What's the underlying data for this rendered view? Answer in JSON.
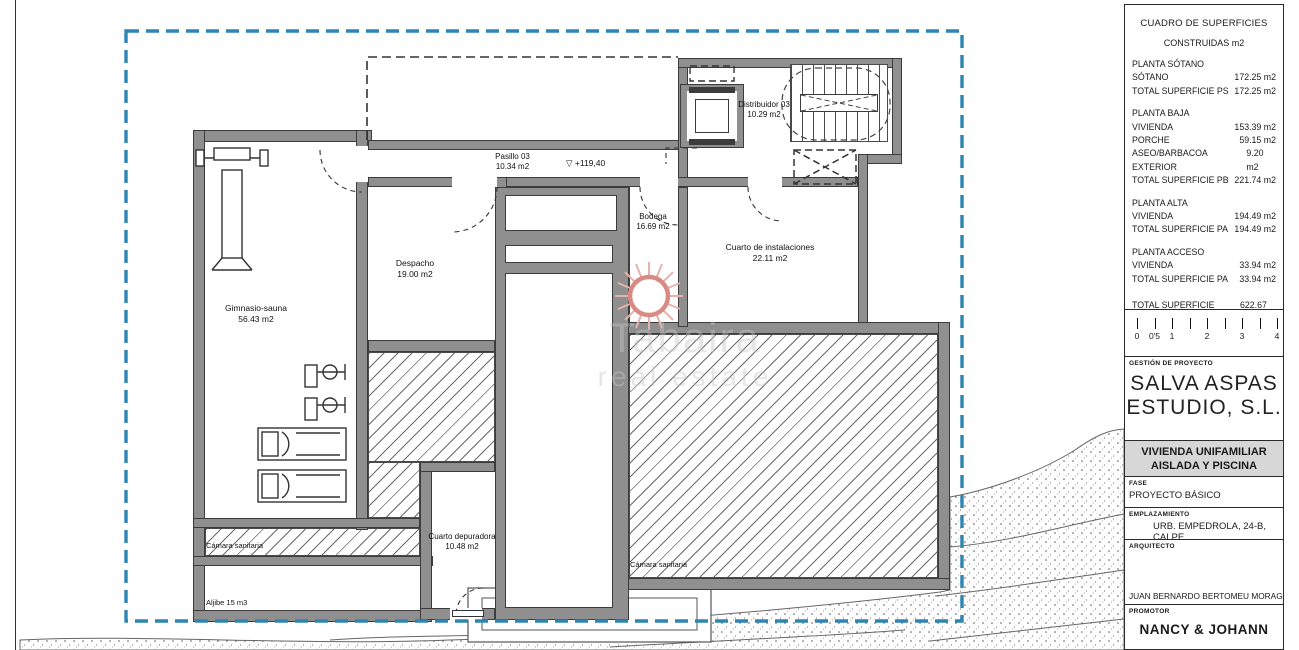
{
  "watermark": {
    "line1": "Tabaira",
    "line2": "real estate"
  },
  "plan": {
    "boundary_color": "#2e84b3",
    "level_mark": "▽ +119,40",
    "rooms": {
      "gym": {
        "name": "Gimnasio-sauna",
        "area": "56.43 m2"
      },
      "despacho": {
        "name": "Despacho",
        "area": "19.00 m2"
      },
      "pasillo": {
        "name": "Pasillo 03",
        "area": "10.34 m2"
      },
      "distribuidor": {
        "name": "Distribuidor 03",
        "area": "10.29 m2"
      },
      "bodega": {
        "name": "Bodega",
        "area": "16.69 m2"
      },
      "instalaciones": {
        "name": "Cuarto de instalaciones",
        "area": "22.11 m2"
      },
      "depuradora": {
        "name": "Cuarto depuradora",
        "area": "10.48 m2"
      }
    },
    "annotations": {
      "camara1": "Cámara sanitaria",
      "camara2": "Cámara sanitaria",
      "aljibe": "Aljibe 15 m3"
    }
  },
  "titleblock": {
    "surfaces": {
      "title": "CUADRO DE SUPERFICIES",
      "subtitle": "CONSTRUIDAS m2",
      "rows": [
        {
          "label": "PLANTA SÓTANO",
          "value": ""
        },
        {
          "label": "SÓTANO",
          "value": "172.25 m2"
        },
        {
          "label": "TOTAL SUPERFICIE PS",
          "value": "172.25 m2"
        },
        {
          "label": "PLANTA BAJA",
          "value": ""
        },
        {
          "label": "VIVIENDA",
          "value": "153.39 m2"
        },
        {
          "label": "PORCHE",
          "value": "59.15 m2"
        },
        {
          "label": "ASEO/BARBACOA EXTERIOR",
          "value": "9.20 m2"
        },
        {
          "label": "TOTAL SUPERFICIE PB",
          "value": "221.74 m2"
        },
        {
          "label": "PLANTA ALTA",
          "value": ""
        },
        {
          "label": "VIVIENDA",
          "value": "194.49 m2"
        },
        {
          "label": "TOTAL SUPERFICIE PA",
          "value": "194.49 m2"
        },
        {
          "label": "PLANTA ACCESO",
          "value": ""
        },
        {
          "label": "VIVIENDA",
          "value": "33.94 m2"
        },
        {
          "label": "TOTAL SUPERFICIE PA",
          "value": "33.94 m2"
        },
        {
          "label": "TOTAL SUPERFICIE CONSTR.",
          "value": "622.67 m2"
        }
      ]
    },
    "scalebar": {
      "labels": [
        "0",
        "0'5",
        "1",
        "2",
        "3",
        "4"
      ]
    },
    "gestion": {
      "label": "GESTIÓN DE PROYECTO",
      "company_line1": "SALVA ASPAS",
      "company_line2": "ESTUDIO, S.L."
    },
    "project": {
      "line1": "VIVIENDA UNIFAMILIAR",
      "line2": "AISLADA Y PISCINA"
    },
    "fase": {
      "label": "FASE",
      "value": "PROYECTO BÁSICO"
    },
    "emplazamiento": {
      "label": "EMPLAZAMIENTO",
      "value": "URB. EMPEDROLA, 24-B, CALPE"
    },
    "arquitecto": {
      "label": "ARQUITECTO",
      "value": "JUAN BERNARDO BERTOMEU MORAGUES"
    },
    "promotor": {
      "label": "PROMOTOR",
      "value": "NANCY & JOHANN"
    }
  }
}
